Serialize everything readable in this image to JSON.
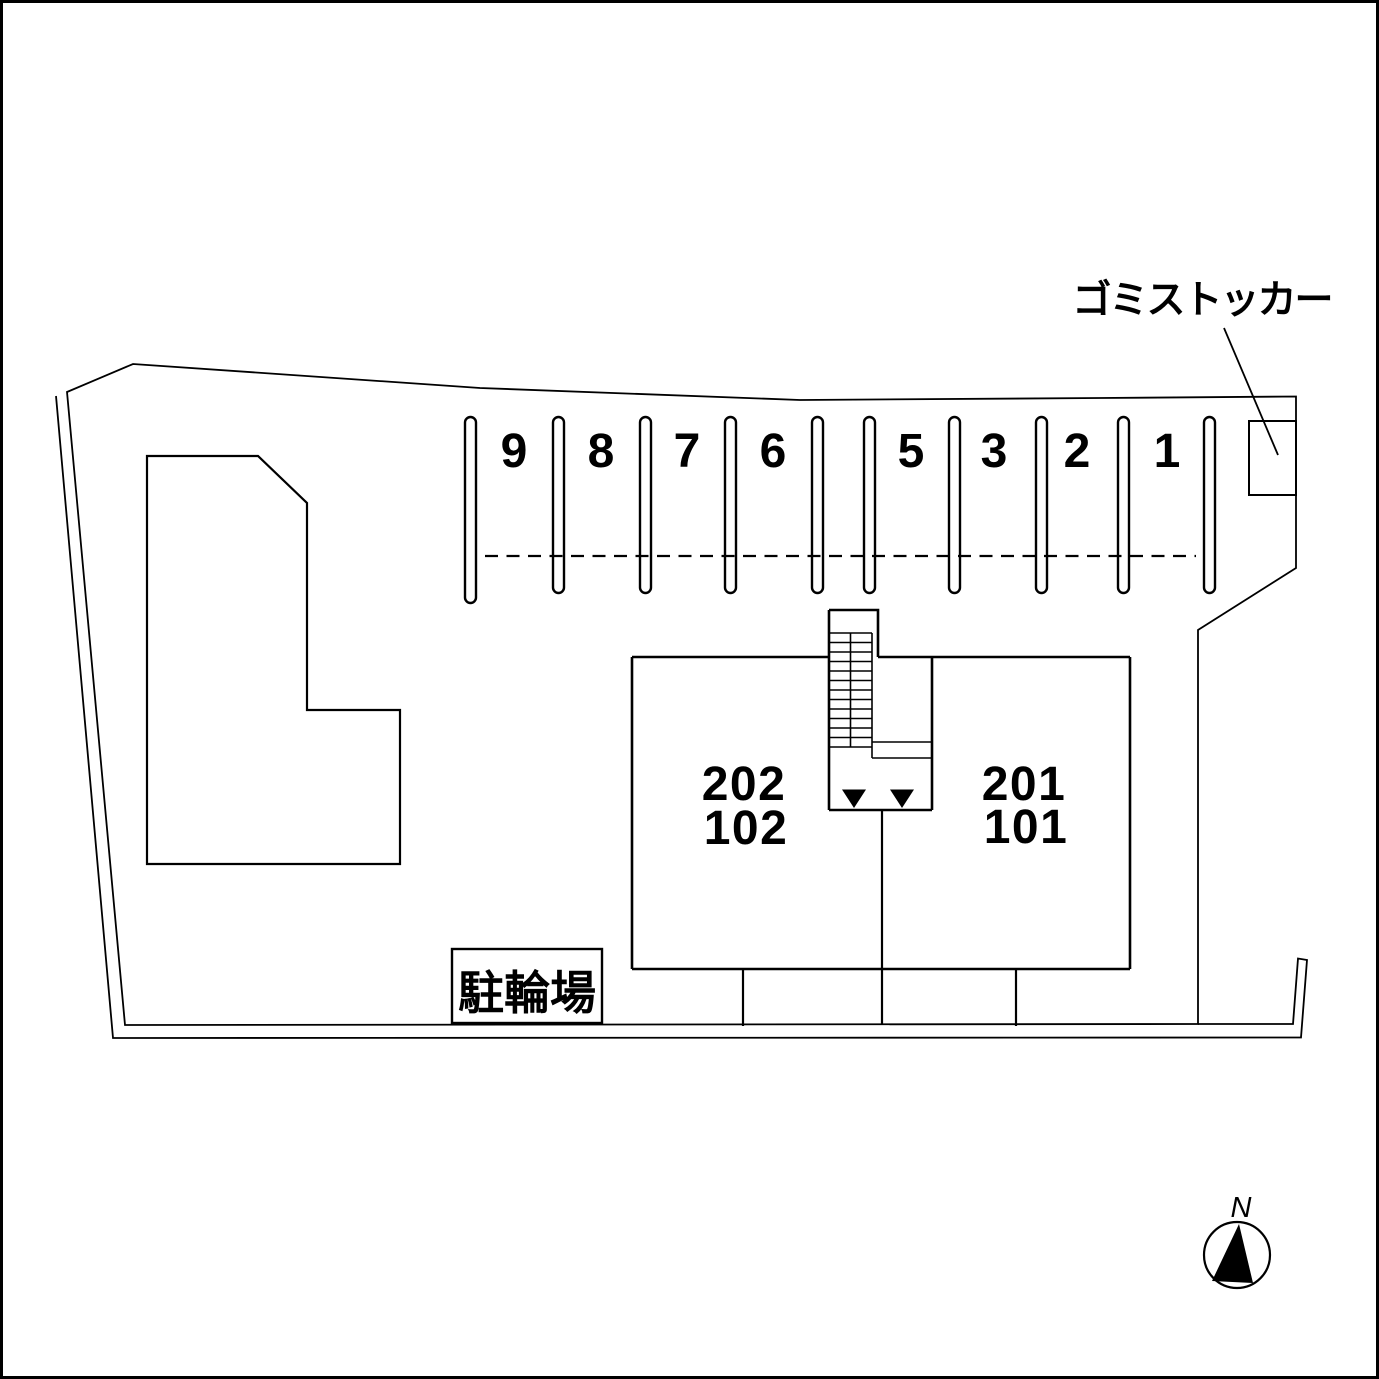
{
  "plan": {
    "parking": {
      "space_labels": [
        "9",
        "8",
        "7",
        "6",
        "5",
        "3",
        "2",
        "1"
      ]
    },
    "building": {
      "left_unit_upper": "202",
      "left_unit_lower": "102",
      "right_unit_upper": "201",
      "right_unit_lower": "101"
    },
    "bicycle_parking_label": "駐輪場",
    "garbage_stocker_label": "ゴミストッカー",
    "compass_north_label": "N",
    "colors": {
      "line": "#000000",
      "background": "#ffffff"
    }
  }
}
